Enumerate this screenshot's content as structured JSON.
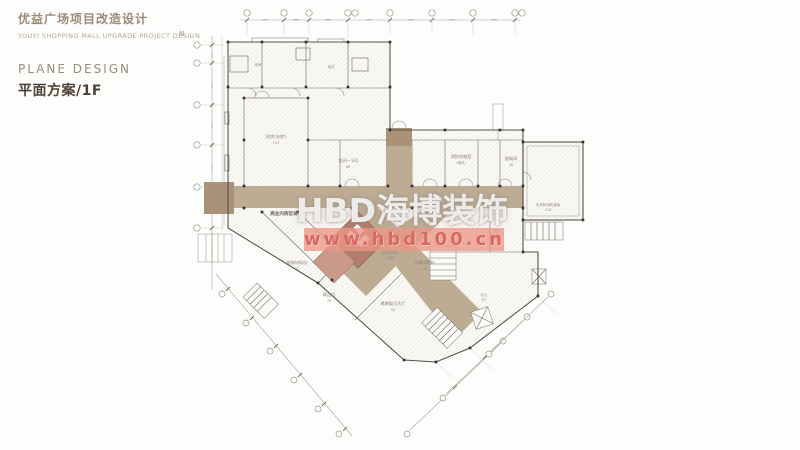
{
  "header": {
    "project_title_cn": "优益广场项目改造设计",
    "project_title_en": "YOUYI SHOPPING MALL UPGRADE PROJECT DESIGN",
    "section_title_en": "PLANE DESIGN",
    "section_title_cn": "平面方案/1F"
  },
  "watermark": {
    "brand": "HBD海博装饰",
    "website": "www.hbd100.cn"
  },
  "plan": {
    "north_indicator": "N",
    "corridor_label": "商业内街区域",
    "colors": {
      "corridor": "#bdac93",
      "corridor_dark": "#aa9279",
      "core": "#b27d6d",
      "core_light": "#c99a8b",
      "watermark_band": "#eb9a8c",
      "watermark_text": "#d9695e",
      "title_brown": "#9b8a76",
      "title_dark": "#4f4234"
    },
    "rooms": [
      {
        "name": "机房(仓库)",
        "num": "113"
      },
      {
        "name": "库房",
        "num": "23"
      },
      {
        "name": "电井",
        "num": ""
      },
      {
        "name": "包间一1间",
        "num": "68"
      },
      {
        "name": "消防控制室",
        "num": "(海关)"
      },
      {
        "name": "配电间",
        "num": "26"
      },
      {
        "name": "装饰材料店",
        "num": "97"
      },
      {
        "name": "精品店",
        "num": "76"
      },
      {
        "name": "棋牌娱乐大厅",
        "num": "54"
      },
      {
        "name": "内廊(购物)",
        "num": "42"
      },
      {
        "name": "新梅本咖啡",
        "num": "(烘焙)"
      },
      {
        "name": "餐厅",
        "num": "26"
      },
      {
        "name": "机房和消防通道",
        "num": "216"
      },
      {
        "name": "办公",
        "num": "87"
      }
    ]
  }
}
